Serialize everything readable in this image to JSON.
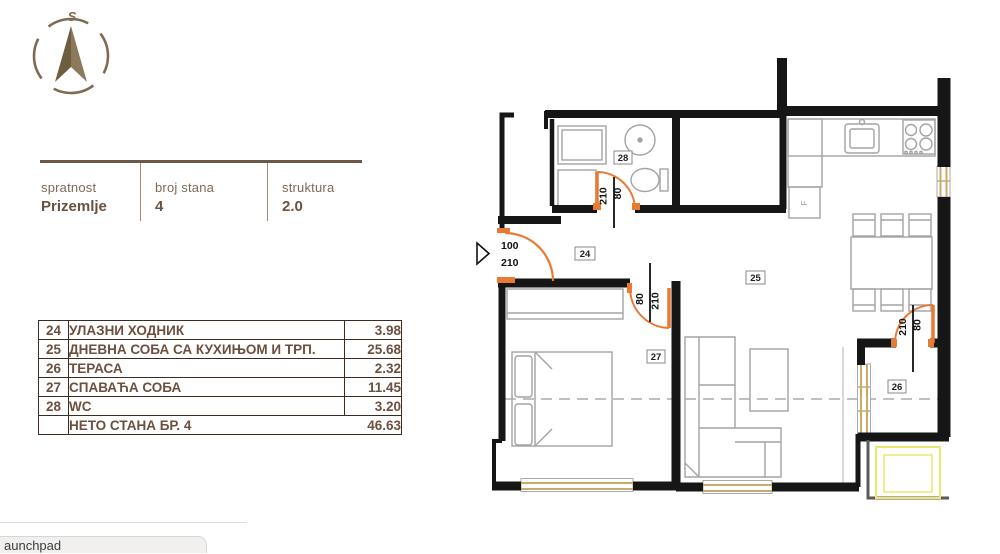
{
  "compass": {
    "north_label": "S"
  },
  "info_header": {
    "cells": [
      {
        "label": "spratnost",
        "value": "Prizemlje"
      },
      {
        "label": "broj stana",
        "value": "4"
      },
      {
        "label": "struktura",
        "value": "2.0"
      }
    ]
  },
  "area_table": {
    "rows": [
      {
        "num": "24",
        "name": "УЛАЗНИ ХОДНИК",
        "area": "3.98"
      },
      {
        "num": "25",
        "name": "ДНЕВНА СОБА СА КУХИЊОМ И ТРП.",
        "area": "25.68"
      },
      {
        "num": "26",
        "name": "ТЕРАСА",
        "area": "2.32"
      },
      {
        "num": "27",
        "name": "СПАВАЋА СОБА",
        "area": "11.45"
      },
      {
        "num": "28",
        "name": "WC",
        "area": "3.20"
      }
    ],
    "total_row": {
      "num": "",
      "name": "НЕТО СТАНА БР. 4",
      "area": "46.63"
    }
  },
  "floor_plan": {
    "room_labels": {
      "hallway": "24",
      "living": "25",
      "terrace": "26",
      "bedroom": "27",
      "wc": "28"
    },
    "dims": {
      "entrance": [
        "100",
        "210"
      ],
      "wc_door": [
        "210",
        "80"
      ],
      "bedroom_door": [
        "80",
        "210"
      ],
      "terrace_door": [
        "210",
        "80"
      ]
    },
    "fridge_label": "F",
    "colors": {
      "wall_black": "#161616",
      "door_orange": "#e87a33",
      "window_tan": "#c9aa6d",
      "balcony_yellow": "#ece76f",
      "furniture_gray": "#a3a3a3"
    }
  },
  "taskbar": {
    "tooltip_text": "aunchpad"
  }
}
